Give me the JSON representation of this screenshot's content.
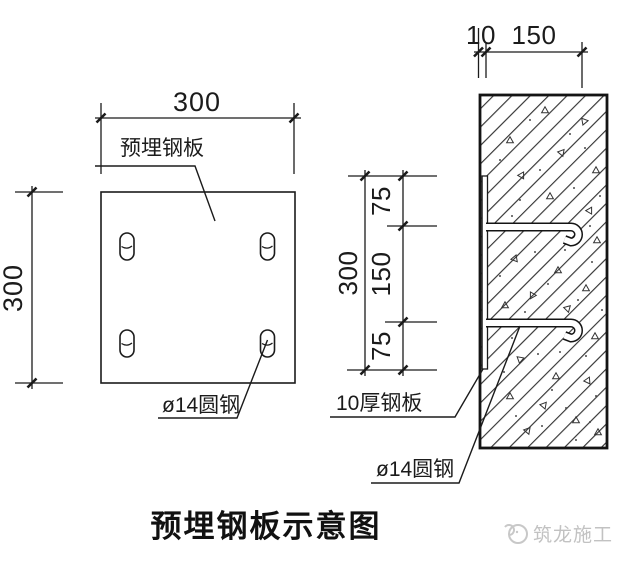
{
  "title": "预埋钢板示意图",
  "watermark": {
    "brand": "筑龙施工"
  },
  "plan_view": {
    "dim_width": "300",
    "dim_height": "300",
    "plate_label": "预埋钢板",
    "anchor_label": "ø14圆钢"
  },
  "section_view": {
    "dim_plate_thickness": "10",
    "dim_anchor_length": "150",
    "dim_top": "75",
    "dim_middle": "150",
    "dim_bottom": "75",
    "dim_total": "300",
    "plate_label": "10厚钢板",
    "anchor_label": "ø14圆钢"
  },
  "colors": {
    "line": "#1b1b1b",
    "watermark": "#c2c2c2"
  }
}
